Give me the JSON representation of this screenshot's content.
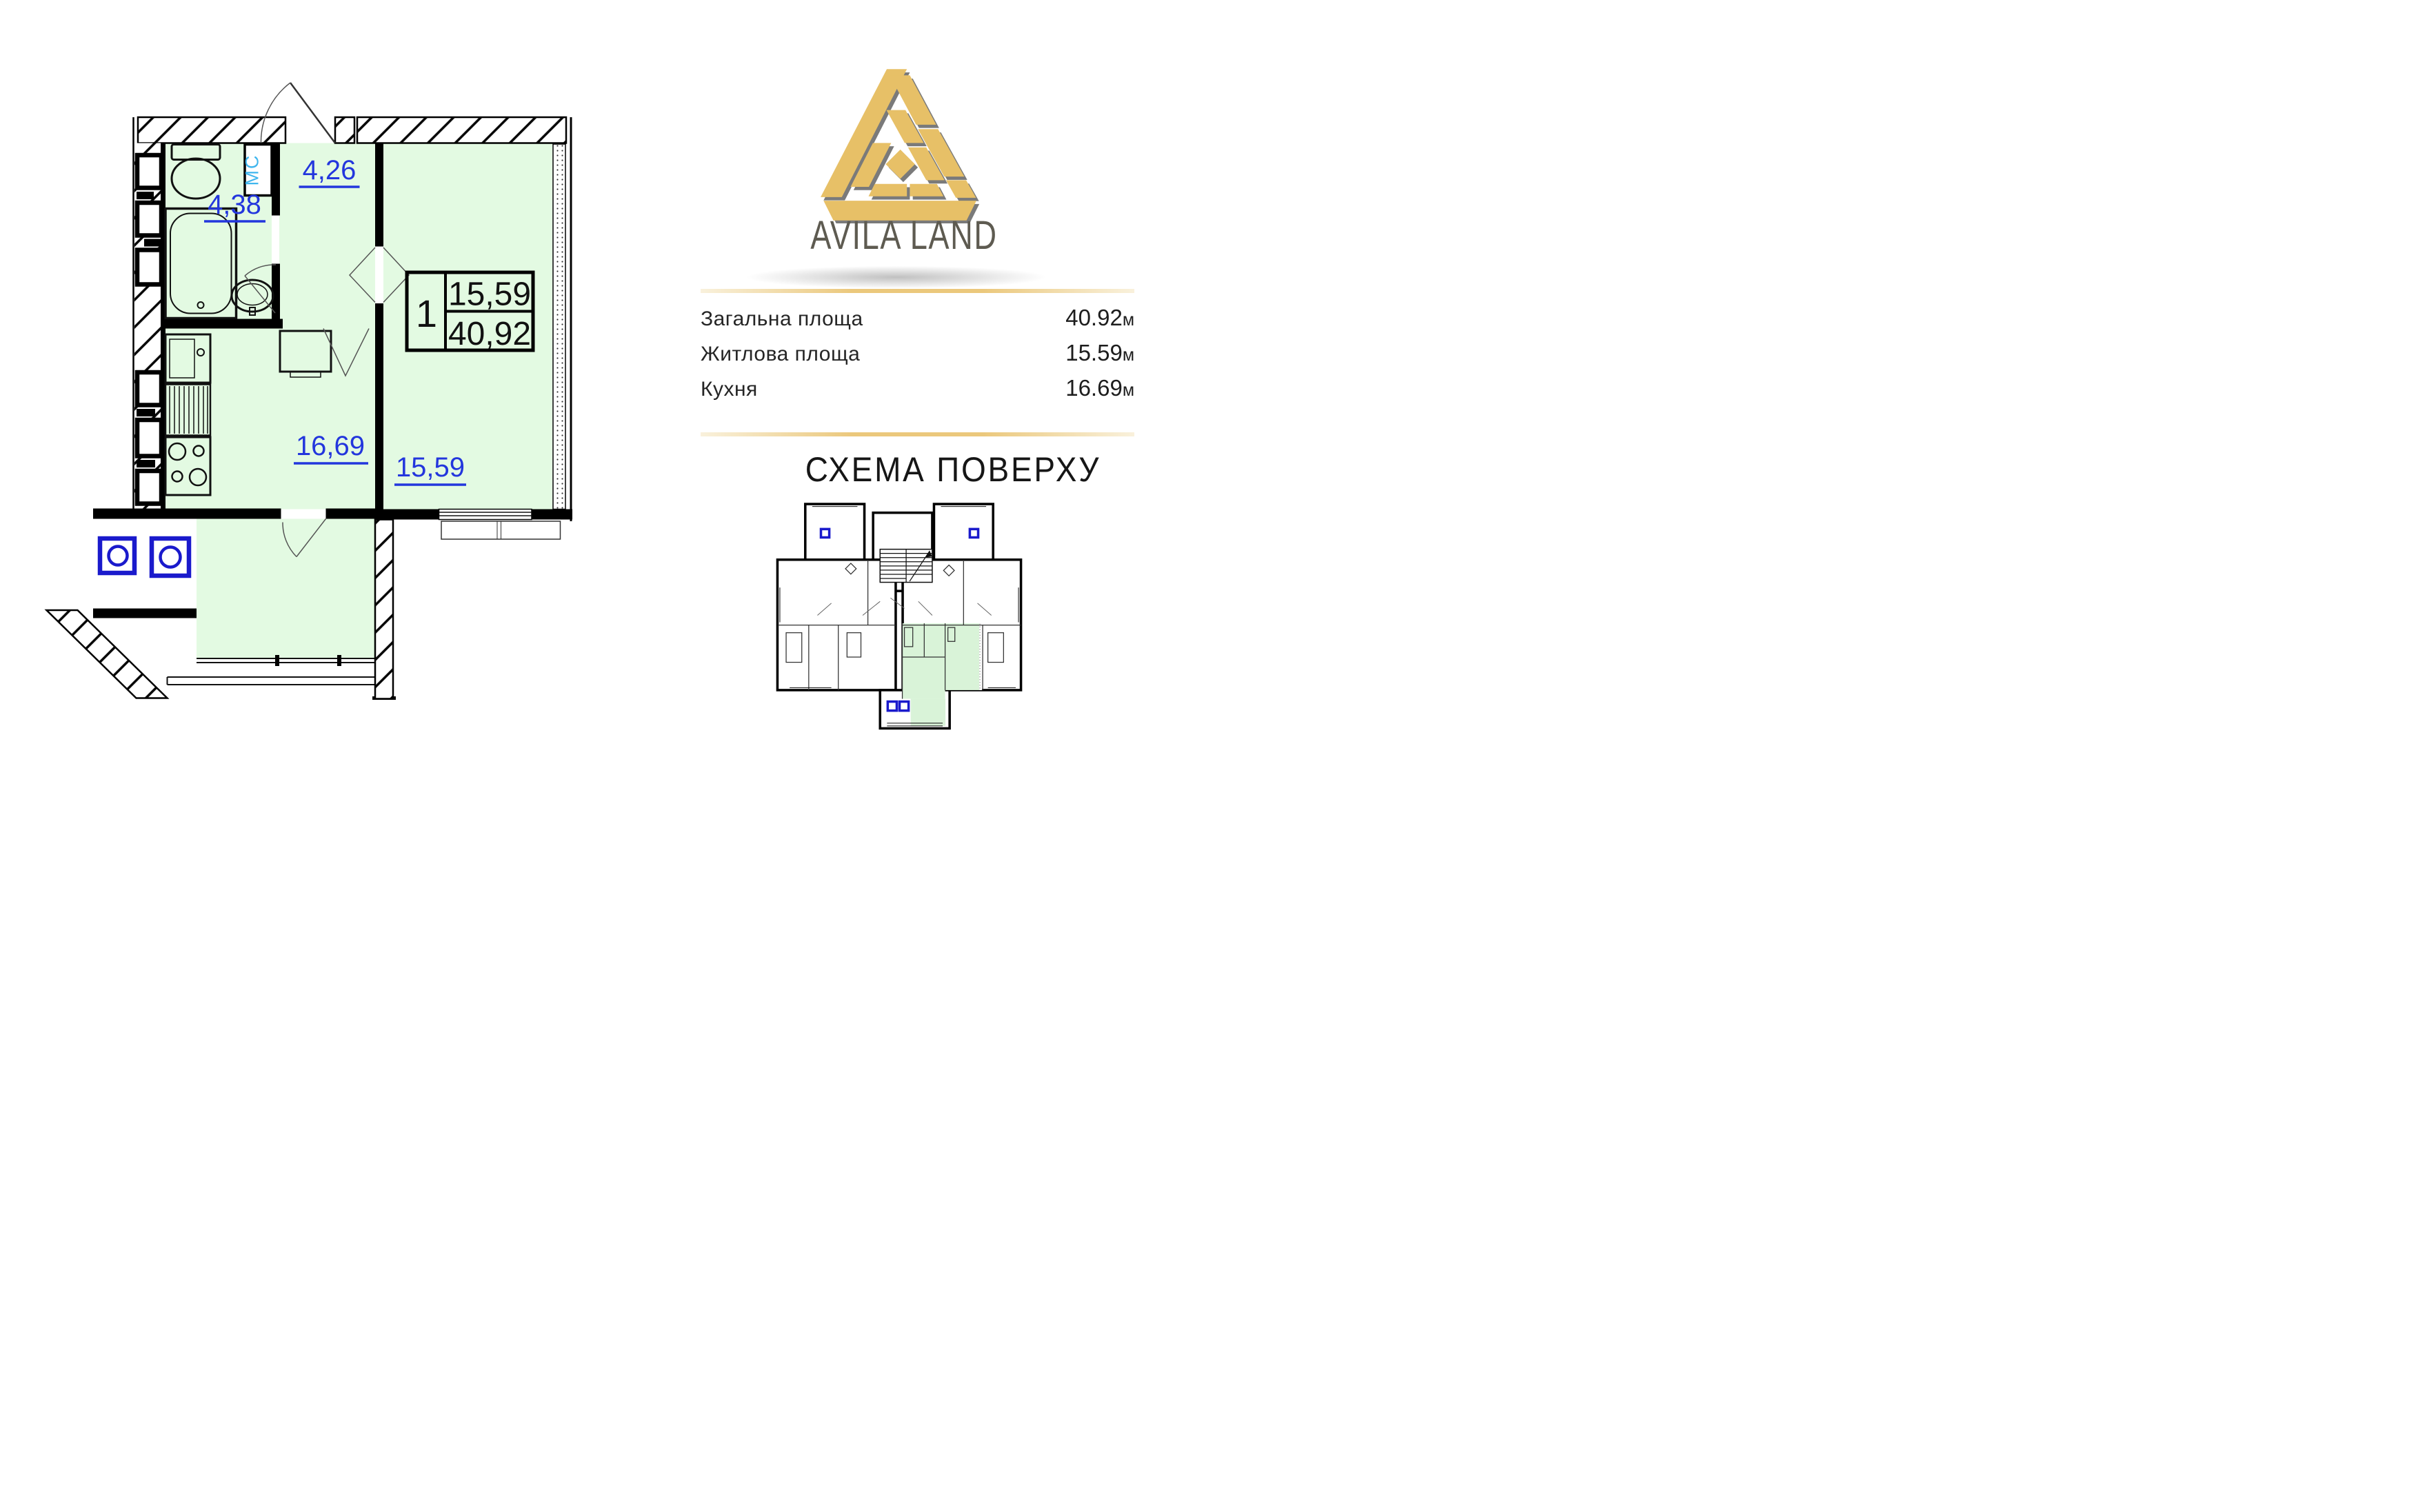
{
  "brand": {
    "name": "AVILA LAND"
  },
  "plan": {
    "rooms": [
      {
        "id": "hallway",
        "area_label": "4,26"
      },
      {
        "id": "bathroom",
        "area_label": "4,38"
      },
      {
        "id": "kitchen",
        "area_label": "16,69"
      },
      {
        "id": "living",
        "area_label": "15,59"
      }
    ],
    "hallway_area": "4,26",
    "bathroom_area": "4,38",
    "kitchen_area": "16,69",
    "living_area": "15,59",
    "washer_label": "МС",
    "unit_box": {
      "rooms_count": "1",
      "living_area": "15,59",
      "total_area": "40,92"
    }
  },
  "stats": {
    "rows": [
      {
        "label": "Загальна площа",
        "value": "40.92",
        "unit": "м"
      },
      {
        "label": "Житлова площа",
        "value": "15.59",
        "unit": "м"
      },
      {
        "label": "Кухня",
        "value": "16.69",
        "unit": "м"
      }
    ]
  },
  "scheme": {
    "title": "СХЕМА ПОВЕРХУ"
  },
  "colors": {
    "room_fill": "#e3fae2",
    "scheme_fill": "#d9f3d8",
    "label_blue": "#2336dd",
    "washer_cyan": "#3fb6ee",
    "logo_gold": "#e7c067",
    "logo_shadow": "#7a7a7a",
    "brand_text": "#5e5b51",
    "rule_gold": "#ebc87c",
    "vent_blue": "#1a1acc",
    "tan_line": "#b2a171"
  }
}
